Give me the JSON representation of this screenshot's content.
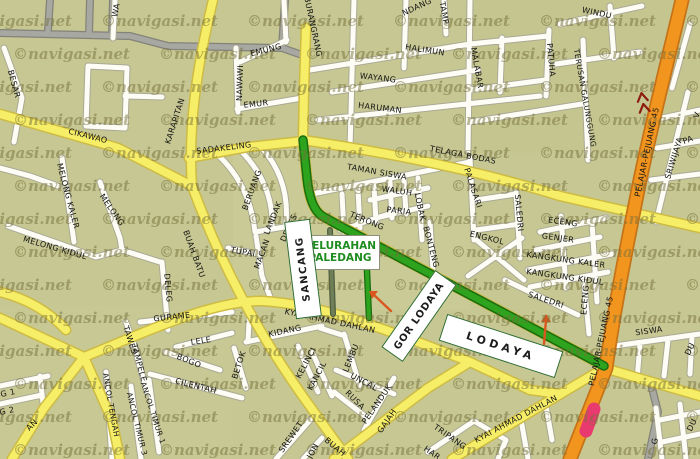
{
  "map": {
    "watermark_text": "©navigasi.net",
    "background_color": "#c6c792",
    "road_colors": {
      "minor_white": "#fdfdf6",
      "collector_yellow": "#f7ee68",
      "major_orange": "#f2951f",
      "rail_gray": "#a8a8a2",
      "route_green": "#2ea31e",
      "marker_pink": "#e83a6e",
      "arrow_orange": "#d9571e"
    },
    "kelurahan_box": {
      "line1": "KELURAHAN",
      "line2": "PALEDANG",
      "x": 339,
      "y": 251,
      "w": 78,
      "h": 33
    },
    "poi_boxes": [
      {
        "id": "sancang",
        "text": "SANCANG",
        "x": 302,
        "y": 268,
        "w": 96,
        "h": 24,
        "rot": -97,
        "size": 10,
        "ls": 1.5
      },
      {
        "id": "gor-lodaya",
        "text": "GOR LODAYA",
        "x": 418,
        "y": 315,
        "w": 92,
        "h": 24,
        "rot": -55,
        "size": 10,
        "ls": 0.8
      },
      {
        "id": "lodaya",
        "text": "LODAYA",
        "x": 500,
        "y": 345,
        "w": 120,
        "h": 26,
        "rot": 18,
        "size": 11,
        "ls": 4
      }
    ],
    "street_labels": [
      {
        "t": "WA",
        "x": 116,
        "y": 10,
        "r": -80
      },
      {
        "t": "BESAR",
        "x": 14,
        "y": 84,
        "r": 75
      },
      {
        "t": "CIKAWAO",
        "x": 88,
        "y": 136,
        "r": 14
      },
      {
        "t": "KARAPITAN",
        "x": 175,
        "y": 121,
        "r": -72
      },
      {
        "t": "NAWAWI",
        "x": 240,
        "y": 83,
        "r": -88
      },
      {
        "t": "EMUNG",
        "x": 266,
        "y": 50,
        "r": -14
      },
      {
        "t": "EMUR",
        "x": 256,
        "y": 104,
        "r": -6
      },
      {
        "t": "BURANGRANG",
        "x": 313,
        "y": 27,
        "r": 78
      },
      {
        "t": "NDANG",
        "x": 417,
        "y": 7,
        "r": -25
      },
      {
        "t": "TAMP",
        "x": 444,
        "y": 13,
        "r": 80
      },
      {
        "t": "HALIMUN",
        "x": 425,
        "y": 50,
        "r": 9
      },
      {
        "t": "WAYANG",
        "x": 378,
        "y": 78,
        "r": 7
      },
      {
        "t": "HARUMAN",
        "x": 380,
        "y": 108,
        "r": 7
      },
      {
        "t": "MALABAR",
        "x": 477,
        "y": 68,
        "r": 80
      },
      {
        "t": "WINDU",
        "x": 597,
        "y": 13,
        "r": 12
      },
      {
        "t": "PATUHA",
        "x": 551,
        "y": 60,
        "r": 85
      },
      {
        "t": "TERUSAN GALUNGGUNG",
        "x": 585,
        "y": 98,
        "r": 80,
        "s": 7.5
      },
      {
        "t": "PELAJAR-PEJUANG 45",
        "x": 647,
        "y": 152,
        "r": -78
      },
      {
        "t": "PELAJAR-PEJUANG 45",
        "x": 601,
        "y": 341,
        "r": -78
      },
      {
        "t": "SRIWIJAYA",
        "x": 674,
        "y": 158,
        "r": -73
      },
      {
        "t": "V",
        "x": 697,
        "y": 115,
        "r": -70
      },
      {
        "t": "PA",
        "x": 688,
        "y": 140,
        "r": -20
      },
      {
        "t": "SADAKELING",
        "x": 224,
        "y": 148,
        "r": -7
      },
      {
        "t": "TELAGA BODAS",
        "x": 463,
        "y": 155,
        "r": 11
      },
      {
        "t": "TAMAN SISWA",
        "x": 377,
        "y": 172,
        "r": 10
      },
      {
        "t": "WALUH",
        "x": 397,
        "y": 191,
        "r": 8
      },
      {
        "t": "PARIA",
        "x": 399,
        "y": 211,
        "r": 6
      },
      {
        "t": "TERONG",
        "x": 367,
        "y": 221,
        "r": 22
      },
      {
        "t": "LOBAK",
        "x": 420,
        "y": 207,
        "r": 78
      },
      {
        "t": "BONTENG",
        "x": 431,
        "y": 247,
        "r": 75
      },
      {
        "t": "PALASARI",
        "x": 473,
        "y": 188,
        "r": 72
      },
      {
        "t": "ENGKOL",
        "x": 487,
        "y": 238,
        "r": 14
      },
      {
        "t": "SALEDRI",
        "x": 519,
        "y": 213,
        "r": 85
      },
      {
        "t": "ECENG",
        "x": 563,
        "y": 222,
        "r": 8
      },
      {
        "t": "GENJER",
        "x": 558,
        "y": 238,
        "r": 8
      },
      {
        "t": "KANGKUNG KALER",
        "x": 566,
        "y": 260,
        "r": 8
      },
      {
        "t": "KANGKUNG KIDUL",
        "x": 565,
        "y": 277,
        "r": 8
      },
      {
        "t": "SALEDRI",
        "x": 546,
        "y": 300,
        "r": 18
      },
      {
        "t": "ECENG",
        "x": 585,
        "y": 300,
        "r": -85
      },
      {
        "t": "SISWA",
        "x": 649,
        "y": 331,
        "r": -8
      },
      {
        "t": "MELONG KALER",
        "x": 68,
        "y": 196,
        "r": 75
      },
      {
        "t": "MELONG",
        "x": 112,
        "y": 210,
        "r": 55
      },
      {
        "t": "MELONG KIDUL",
        "x": 55,
        "y": 248,
        "r": 16
      },
      {
        "t": "BERUANG",
        "x": 252,
        "y": 190,
        "r": -70
      },
      {
        "t": "LANDAK",
        "x": 273,
        "y": 218,
        "r": -68
      },
      {
        "t": "DEDES",
        "x": 289,
        "y": 228,
        "r": -65
      },
      {
        "t": "MACAN",
        "x": 262,
        "y": 254,
        "r": -70
      },
      {
        "t": "TUPAI",
        "x": 243,
        "y": 252,
        "r": 10
      },
      {
        "t": "BUAH BATU",
        "x": 194,
        "y": 254,
        "r": 70
      },
      {
        "t": "DELEG",
        "x": 168,
        "y": 288,
        "r": 85
      },
      {
        "t": "GURAME",
        "x": 172,
        "y": 317,
        "r": -6
      },
      {
        "t": "TAWES",
        "x": 130,
        "y": 340,
        "r": 72
      },
      {
        "t": "TAMPELE",
        "x": 139,
        "y": 363,
        "r": 75
      },
      {
        "t": "LELE",
        "x": 201,
        "y": 341,
        "r": -8
      },
      {
        "t": "BOGO",
        "x": 189,
        "y": 361,
        "r": 22
      },
      {
        "t": "CILENTAH",
        "x": 196,
        "y": 386,
        "r": 14
      },
      {
        "t": "ANCOL TENGAH",
        "x": 111,
        "y": 405,
        "r": 80,
        "s": 7.5
      },
      {
        "t": "ANCOL TIMUR 3",
        "x": 137,
        "y": 424,
        "r": 76,
        "s": 7.5
      },
      {
        "t": "ANCOL TIMUR 1",
        "x": 153,
        "y": 413,
        "r": 72,
        "s": 7.5
      },
      {
        "t": "G 1",
        "x": 8,
        "y": 393,
        "r": -12
      },
      {
        "t": "G 2",
        "x": 7,
        "y": 411,
        "r": -12
      },
      {
        "t": "AN",
        "x": 32,
        "y": 425,
        "r": -45
      },
      {
        "t": "KYAI AHMAD DAHLAN",
        "x": 330,
        "y": 321,
        "r": 12
      },
      {
        "t": "KIDANG",
        "x": 285,
        "y": 331,
        "r": -12
      },
      {
        "t": "BETOK",
        "x": 239,
        "y": 365,
        "r": -72
      },
      {
        "t": "KELINCI",
        "x": 306,
        "y": 363,
        "r": -62
      },
      {
        "t": "KANCIL",
        "x": 317,
        "y": 376,
        "r": -62
      },
      {
        "t": "LEMBU",
        "x": 351,
        "y": 358,
        "r": -68
      },
      {
        "t": "UNCAL",
        "x": 364,
        "y": 382,
        "r": 28
      },
      {
        "t": "RUSA",
        "x": 355,
        "y": 400,
        "r": 45
      },
      {
        "t": "PELANDUK",
        "x": 377,
        "y": 404,
        "r": -55
      },
      {
        "t": "GAJAH",
        "x": 387,
        "y": 421,
        "r": -55
      },
      {
        "t": "SREWET",
        "x": 291,
        "y": 437,
        "r": -55
      },
      {
        "t": "JON",
        "x": 313,
        "y": 451,
        "r": -60
      },
      {
        "t": "BUAH",
        "x": 335,
        "y": 447,
        "r": 40
      },
      {
        "t": "TRIPANG",
        "x": 450,
        "y": 437,
        "r": 35
      },
      {
        "t": "HAR",
        "x": 432,
        "y": 453,
        "r": 35
      },
      {
        "t": "KYAI AHMAD DAHLAN",
        "x": 516,
        "y": 419,
        "r": -28
      },
      {
        "t": "KYA",
        "x": 458,
        "y": 325,
        "r": 20
      },
      {
        "t": "DU",
        "x": 690,
        "y": 349,
        "r": -65
      },
      {
        "t": "DU",
        "x": 692,
        "y": 425,
        "r": -65
      },
      {
        "t": "G",
        "x": 655,
        "y": 441,
        "r": -80
      }
    ]
  }
}
